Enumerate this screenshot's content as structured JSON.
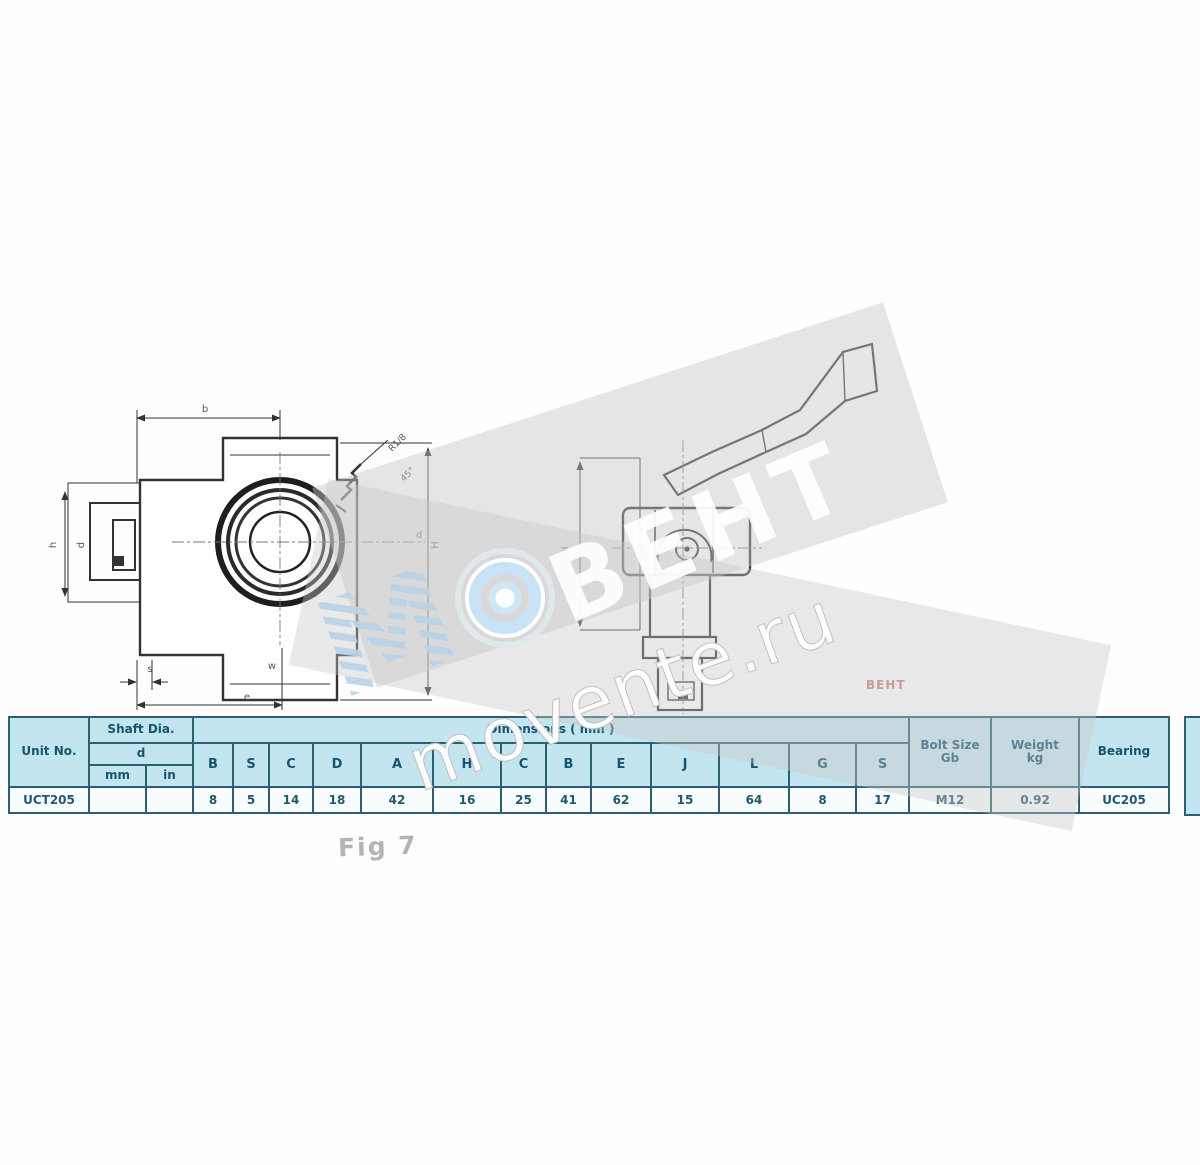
{
  "watermark": {
    "letter": "М",
    "brand": "ВЕНТ",
    "url": "movente.ru"
  },
  "stamp": {
    "text": "ВЕНТ"
  },
  "figure": {
    "caption": "Fig 7"
  },
  "drawing": {
    "front_labels": {
      "top": "b",
      "height": "H",
      "left_outer": "h",
      "left_inner": "d",
      "bottom_small": "s",
      "bottom_mid": "w",
      "bottom_wide": "e",
      "bore": "d",
      "grease_1": "R1/8",
      "grease_2": "45°"
    },
    "side_labels": {
      "height": "H"
    }
  },
  "table": {
    "unit": {
      "header": "Unit No.",
      "value": "UCT205"
    },
    "shaft": {
      "title": "Shaft Dia.",
      "symbol": "d",
      "unit_mm": "mm",
      "unit_in": "in",
      "value_mm": "",
      "value_in": ""
    },
    "dims": {
      "title": "Dimensions ( mm )",
      "letters": [
        "B",
        "S",
        "C",
        "D",
        "A",
        "H",
        "C",
        "B",
        "E",
        "J",
        "L",
        "G",
        "S"
      ],
      "values": [
        "8",
        "5",
        "14",
        "18",
        "42",
        "16",
        "25",
        "41",
        "62",
        "15",
        "64",
        "8",
        "17"
      ]
    },
    "extras": [
      {
        "line1": "Bolt Size",
        "line2": "Gb",
        "value": "M12"
      },
      {
        "line1": "Weight",
        "line2": "kg",
        "value": "0.92"
      },
      {
        "line1": "Bearing",
        "line2": "",
        "value": "UC205"
      }
    ]
  },
  "colors": {
    "table_border": "#2a6070",
    "header_bg": "#c3e5ef",
    "text": "#17556e",
    "stamp": "#c58787"
  }
}
